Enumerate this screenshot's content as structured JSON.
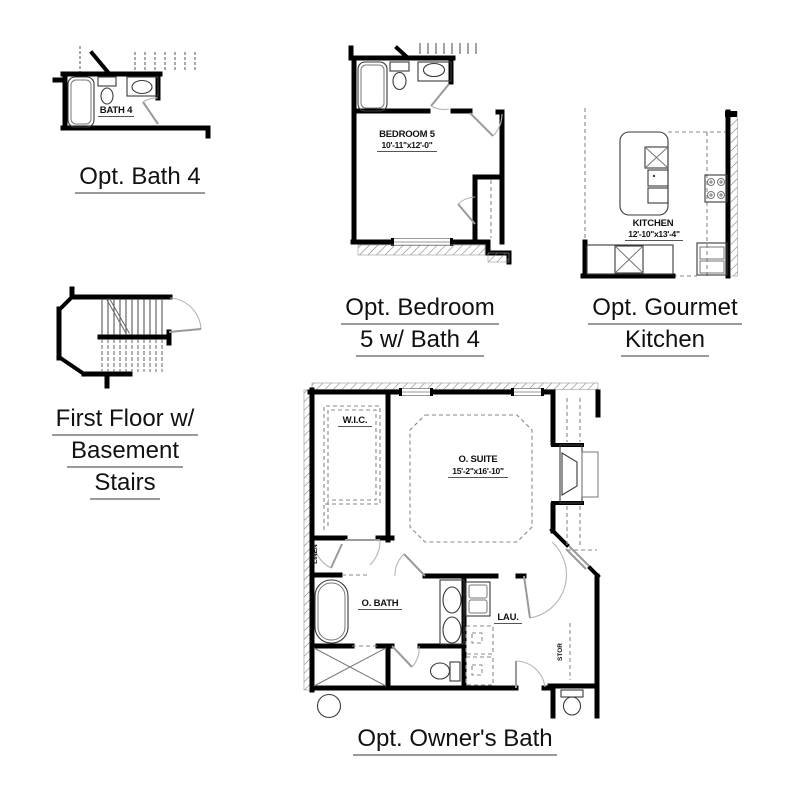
{
  "sheet": {
    "background": "#ffffff"
  },
  "colors": {
    "wall": "#000000",
    "fixture": "#3a3a3a",
    "door": "#9a9a9a",
    "underline": "#9a9a9a",
    "text": "#111111"
  },
  "plans": {
    "bath4": {
      "title": "Opt. Bath 4",
      "room_label": "BATH 4"
    },
    "bedroom5": {
      "title_line1": "Opt. Bedroom",
      "title_line2": "5 w/ Bath 4",
      "room_label": "BEDROOM 5",
      "room_dims": "10'-11\"x12'-0\""
    },
    "kitchen": {
      "title_line1": "Opt. Gourmet",
      "title_line2": "Kitchen",
      "room_label": "KITCHEN",
      "room_dims": "12'-10\"x13'-4\""
    },
    "basement_stairs": {
      "title_line1": "First Floor w/",
      "title_line2": "Basement",
      "title_line3": "Stairs"
    },
    "owners_bath": {
      "title": "Opt. Owner's Bath",
      "labels": {
        "wic": "W.I.C.",
        "suite": "O. SUITE",
        "suite_dims": "15'-2\"x16'-10\"",
        "linen": "LINEN",
        "bath": "O. BATH",
        "laundry": "LAU.",
        "storage": "STOR"
      }
    }
  }
}
